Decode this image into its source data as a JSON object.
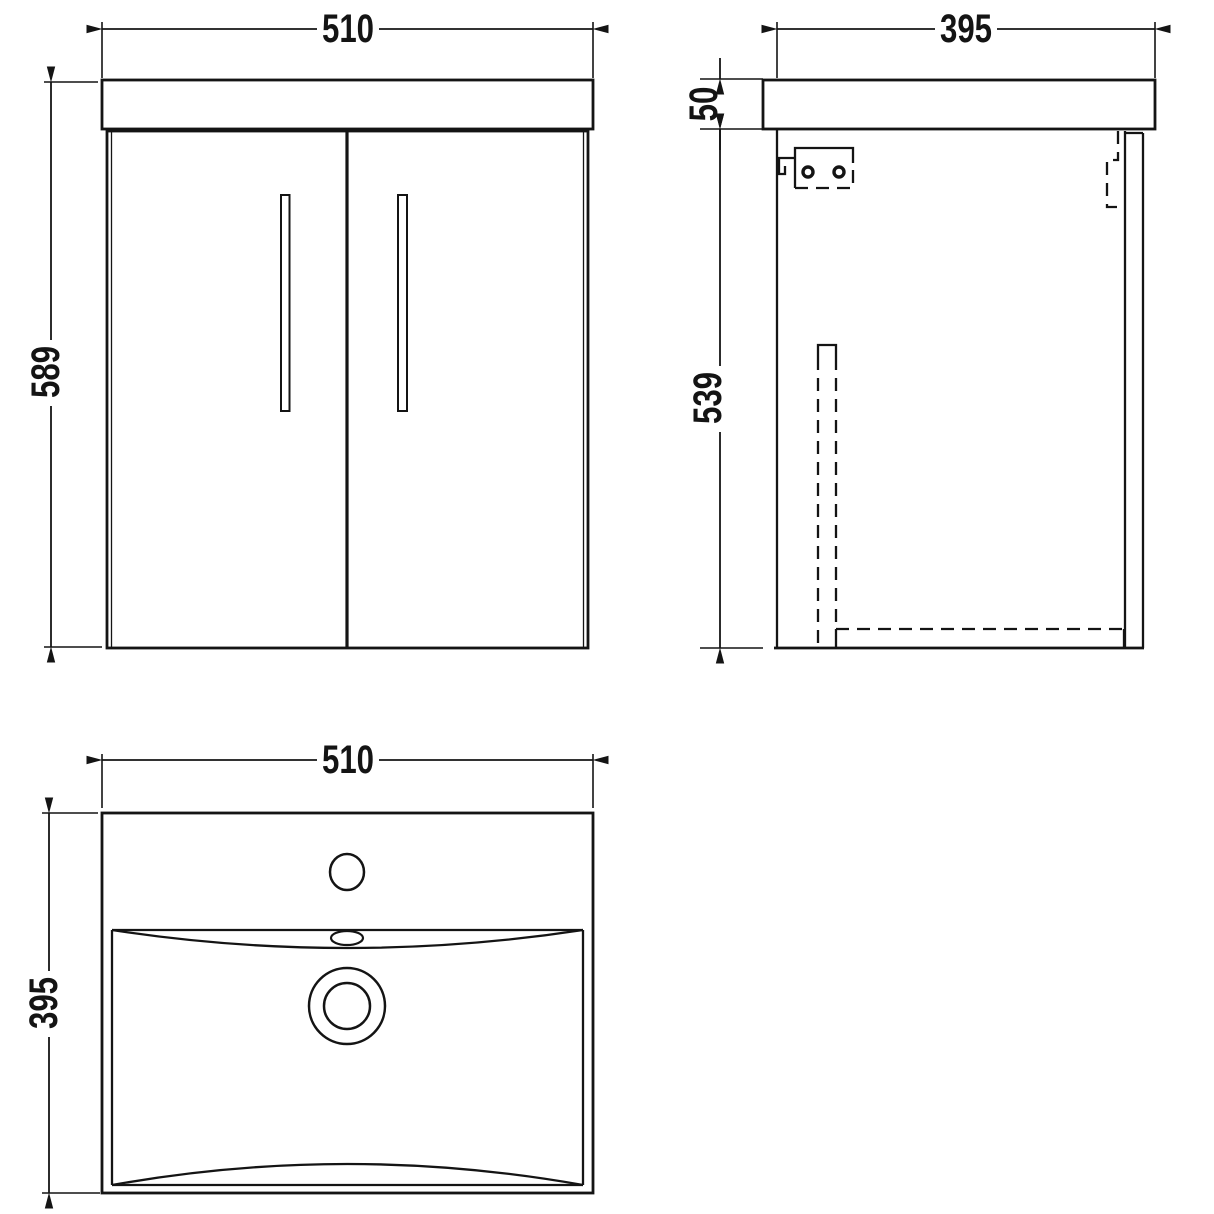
{
  "colors": {
    "background": "#ffffff",
    "line": "#141414"
  },
  "views": {
    "front": {
      "width": "510",
      "height": "589"
    },
    "side": {
      "depth": "395",
      "worktop_thickness": "50",
      "body_height": "539"
    },
    "plan": {
      "width": "510",
      "depth": "395"
    }
  }
}
